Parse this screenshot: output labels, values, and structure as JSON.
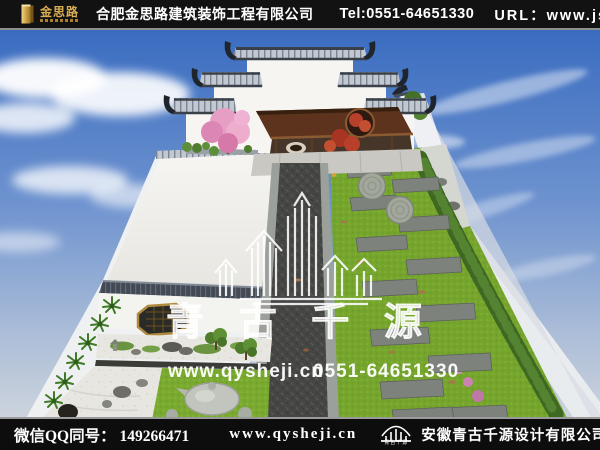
{
  "header": {
    "logo_text": "金思路",
    "company_name": "合肥金思路建筑装饰工程有限公司",
    "tel": "Tel:0551-64651330",
    "url_label": "URL：",
    "url_value": "www.jslu.cn"
  },
  "watermark": {
    "brand": "青 古 千 源",
    "site": "www.qysheji.cn",
    "phone": "0551-64651330"
  },
  "footer": {
    "qq_label": "微信QQ同号：",
    "qq_number": "149266471",
    "website": "www.qysheji.cn",
    "logo_caption": "青古千源",
    "company": "安徽青古千源设计有限公司"
  },
  "colors": {
    "bar_background": "#121212",
    "accent_gold": "#d9ad52",
    "sky_blue": "#3f70c0",
    "lawn_green": "#7aa92f",
    "pavilion_brown": "#5d331d",
    "watermark_white": "#ffffff"
  }
}
